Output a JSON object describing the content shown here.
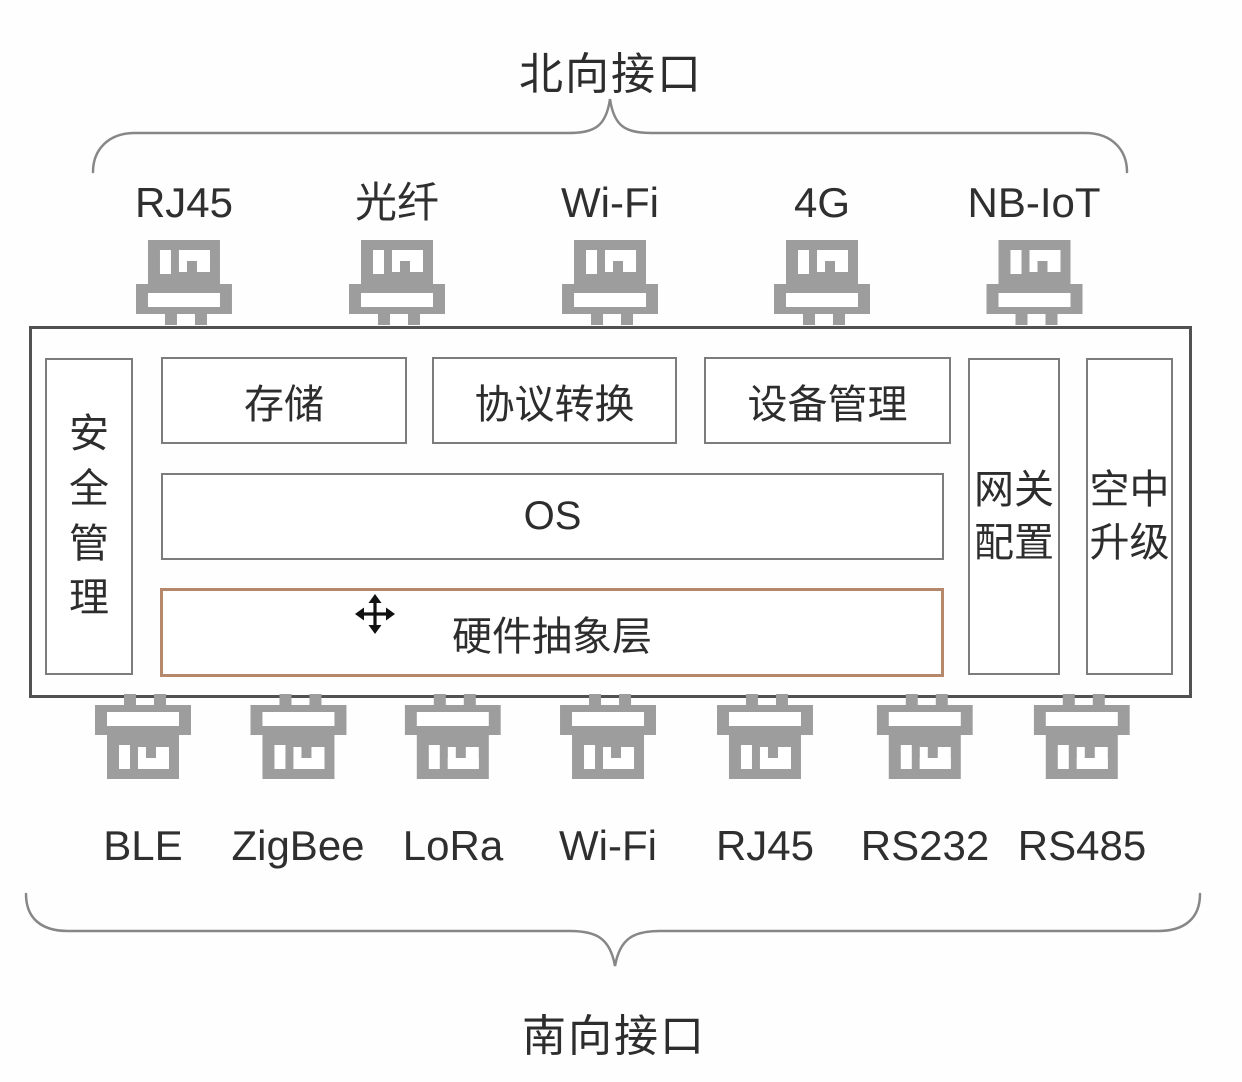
{
  "north": {
    "label": "北向接口",
    "ports": [
      {
        "label": "RJ45"
      },
      {
        "label": "光纤"
      },
      {
        "label": "Wi-Fi"
      },
      {
        "label": "4G"
      },
      {
        "label": "NB-IoT"
      }
    ]
  },
  "south": {
    "label": "南向接口",
    "ports": [
      {
        "label": "BLE"
      },
      {
        "label": "ZigBee"
      },
      {
        "label": "LoRa"
      },
      {
        "label": "Wi-Fi"
      },
      {
        "label": "RJ45"
      },
      {
        "label": "RS232"
      },
      {
        "label": "RS485"
      }
    ]
  },
  "gateway": {
    "security_column": "安全管理",
    "top_modules": [
      {
        "label": "存储"
      },
      {
        "label": "协议转换"
      },
      {
        "label": "设备管理"
      }
    ],
    "os_layer": "OS",
    "hal_layer": "硬件抽象层",
    "right_modules": [
      {
        "label": "网关配置"
      },
      {
        "label": "空中升级"
      }
    ]
  },
  "colors": {
    "port_icon_gray": "#9d9d9d",
    "module_border": "#7c7c7c",
    "outer_border": "#515151",
    "hal_border": "#b5876b",
    "brace": "#878787",
    "text": "#2d2d2d"
  }
}
